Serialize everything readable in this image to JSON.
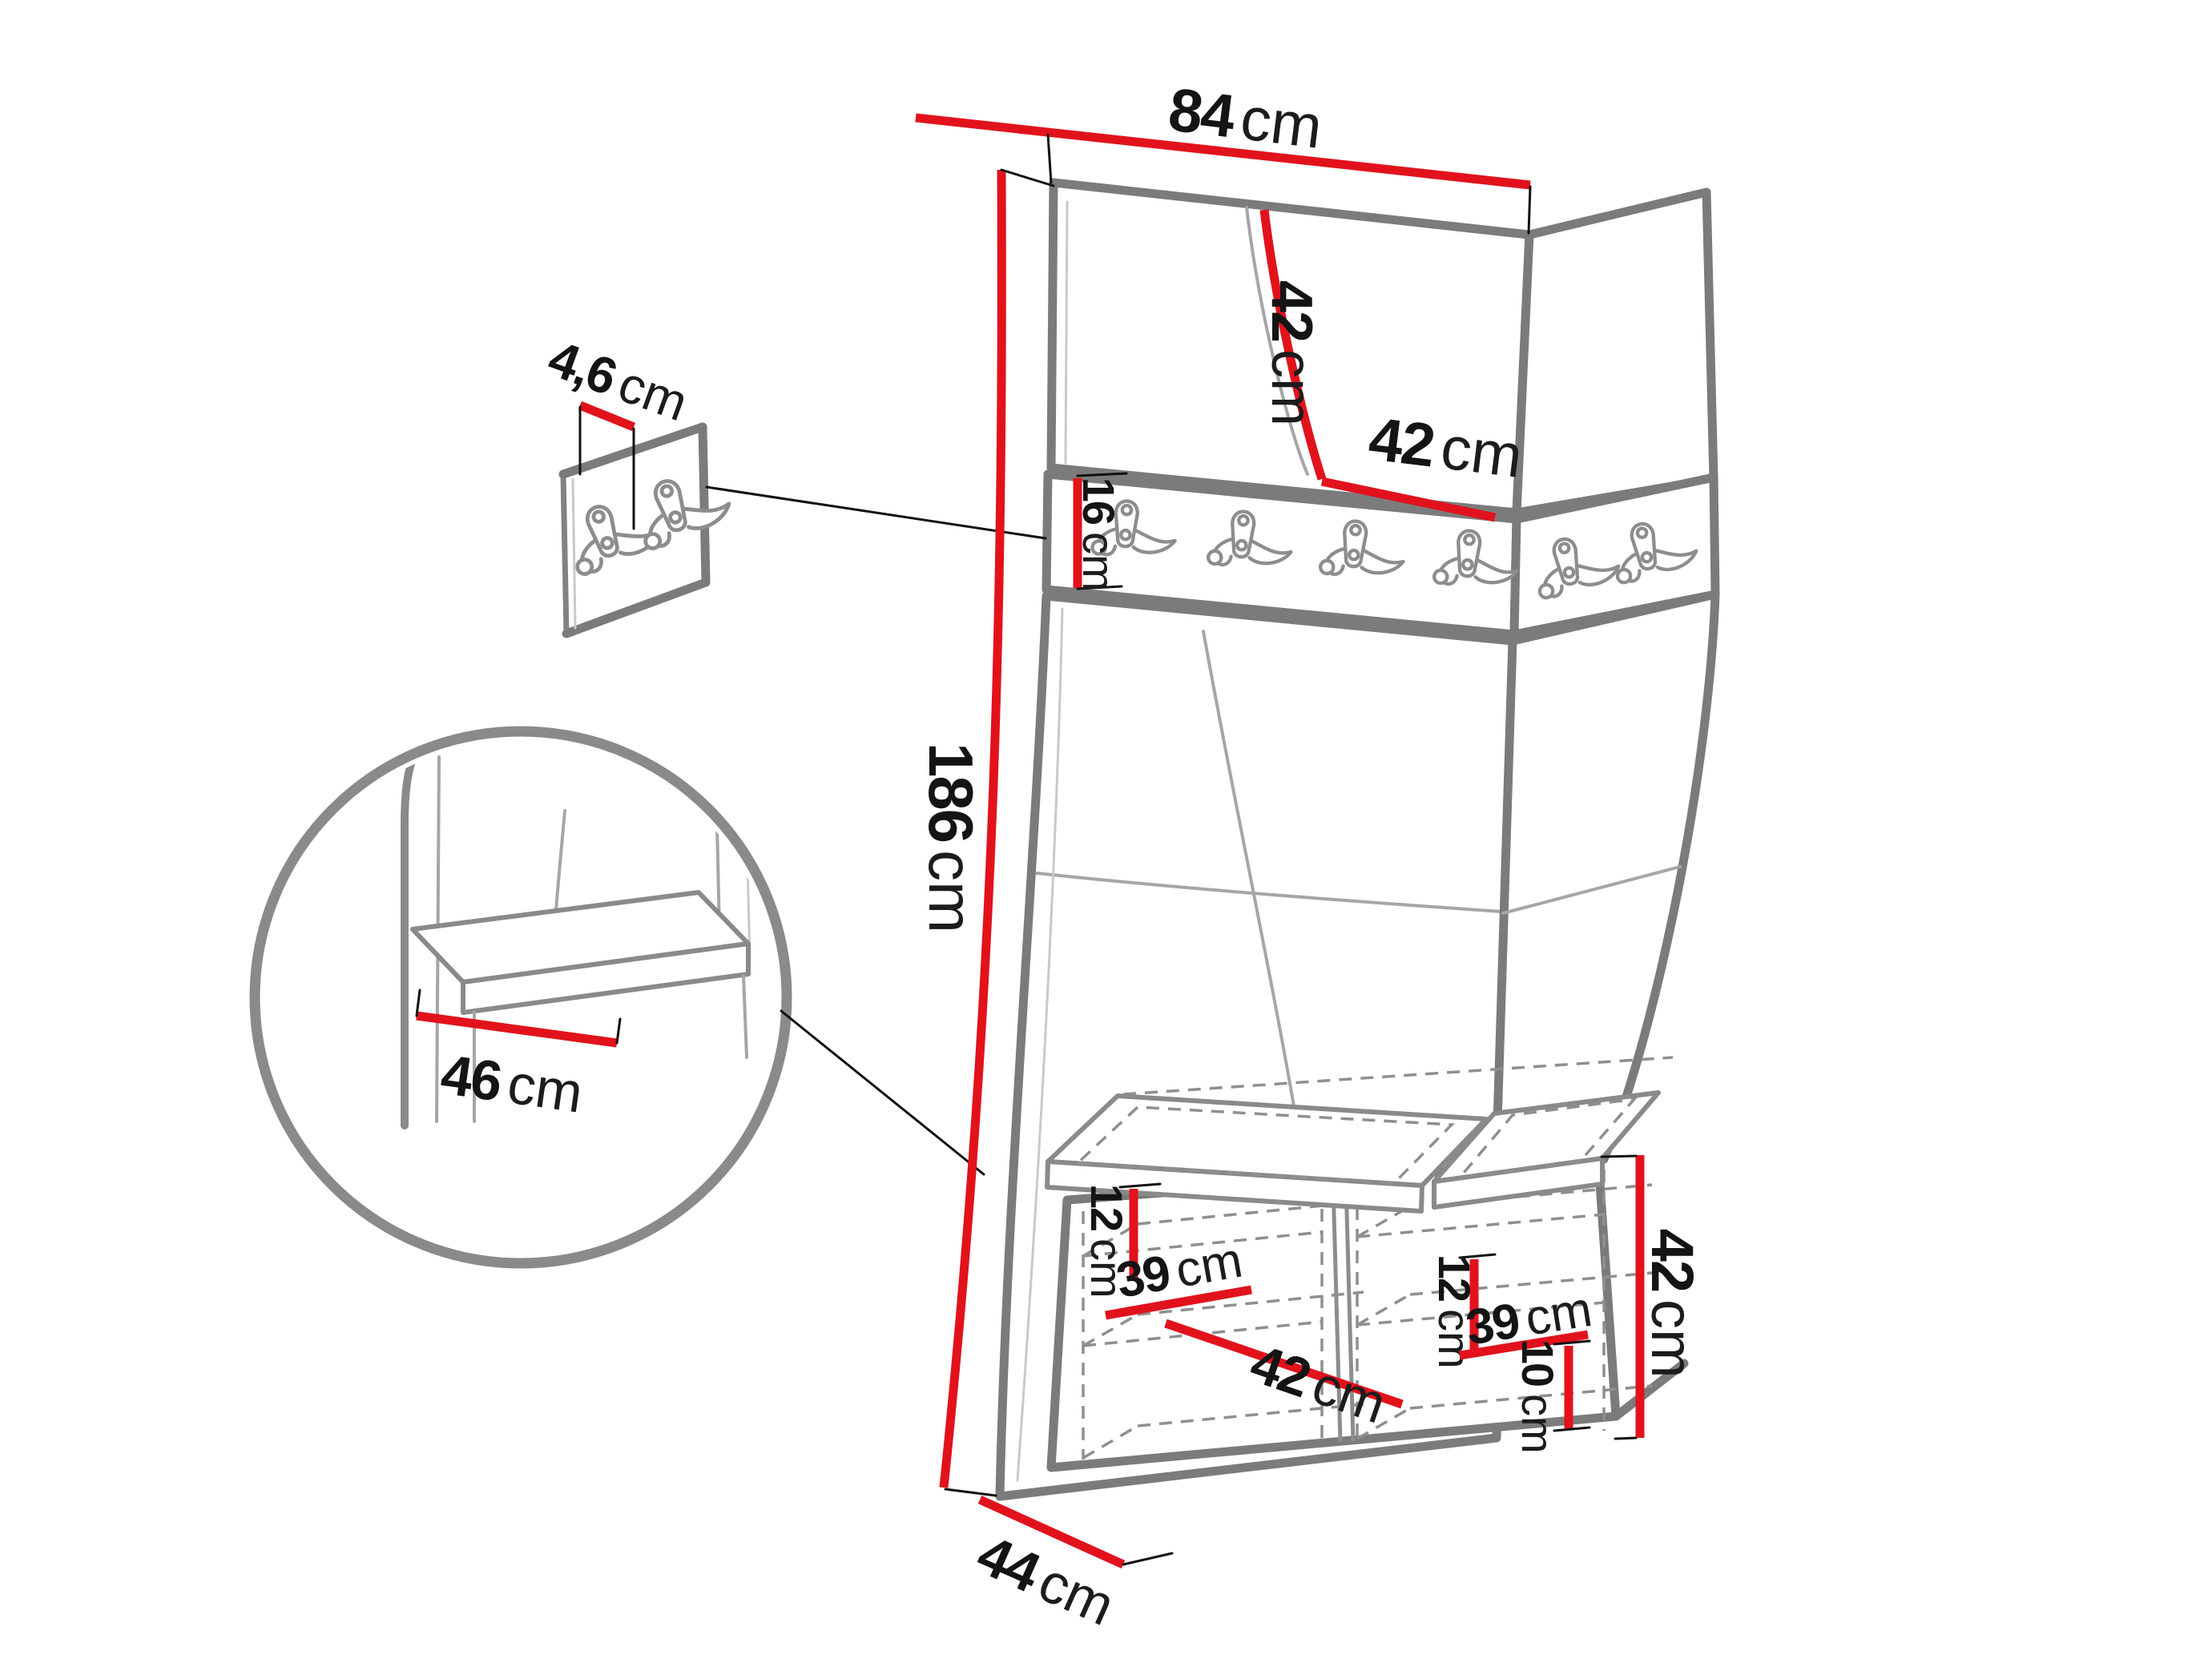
{
  "figure": {
    "kind": "furniture-dimension-diagram",
    "subject": "corner hallway unit with coat-hook rail, upholstered panels, bench and shoe cabinets"
  },
  "colors": {
    "dimension_red": "#e2121c",
    "edge_gray": "#7b7b7b",
    "seam_gray": "#a6a6a6",
    "text_black": "#141414",
    "background": "#ffffff"
  },
  "icons": {
    "rail_hook": "double-coat-hook",
    "rail_hook_count": 6,
    "detail_panel_hook_count": 2
  },
  "dimensions": {
    "top_width": {
      "value": "84",
      "unit": "cm"
    },
    "top_panel_height": {
      "value": "42",
      "unit": "cm"
    },
    "top_panel_width": {
      "value": "42",
      "unit": "cm"
    },
    "panel_thickness": {
      "value": "4,6",
      "unit": "cm"
    },
    "hook_rail_height": {
      "value": "16",
      "unit": "cm"
    },
    "total_height": {
      "value": "186",
      "unit": "cm"
    },
    "bench_seat_depth": {
      "value": "46",
      "unit": "cm"
    },
    "left_shelf_spacing": {
      "value": "12",
      "unit": "cm"
    },
    "left_shelf_depth": {
      "value": "39",
      "unit": "cm"
    },
    "left_cabinet_width": {
      "value": "42",
      "unit": "cm"
    },
    "right_shelf_spacing": {
      "value": "12",
      "unit": "cm"
    },
    "right_shelf_depth": {
      "value": "39",
      "unit": "cm"
    },
    "right_plinth_height": {
      "value": "10",
      "unit": "cm"
    },
    "bench_height": {
      "value": "42",
      "unit": "cm"
    },
    "unit_depth": {
      "value": "44",
      "unit": "cm"
    }
  }
}
